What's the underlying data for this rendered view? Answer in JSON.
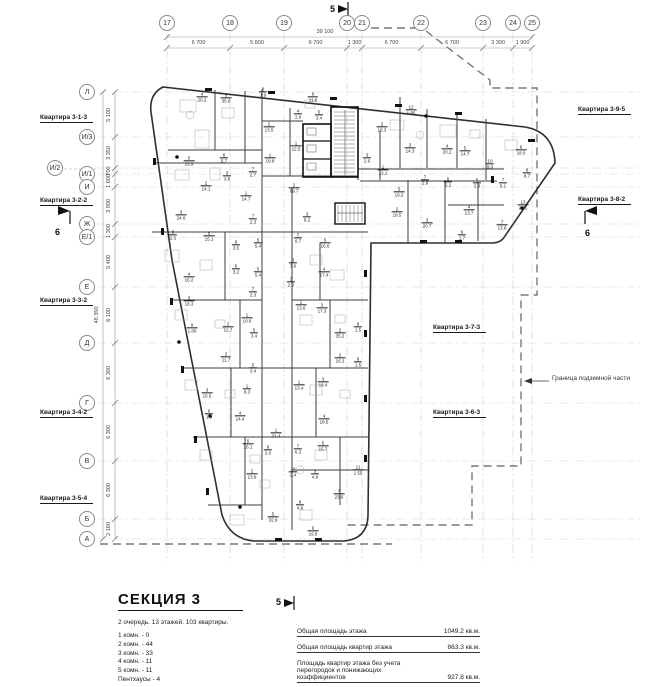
{
  "legend": {
    "title": "СЕКЦИЯ 3",
    "subtitle": "2 очередь. 13 этажей. 103 квартиры.",
    "unit_counts": [
      "1 комн. - 0",
      "2 комн. - 44",
      "3 комн. - 33",
      "4 комн. - 11",
      "5 комн. - 11",
      "Пентхаусы - 4"
    ],
    "totals": [
      {
        "label": "Общая площадь этажа",
        "value": "1049.2 кв.м."
      },
      {
        "label": "Общая площадь квартир этажа",
        "value": "863.3 кв.м."
      },
      {
        "label": "Площадь квартир этажа без учета перегородок и понижающих коэффициентов",
        "value": "927.8 кв.м."
      }
    ]
  },
  "boundary": {
    "label": "Граница подземной части"
  },
  "grid": {
    "columns": [
      {
        "label": "17",
        "x": 167
      },
      {
        "label": "18",
        "x": 230
      },
      {
        "label": "19",
        "x": 284
      },
      {
        "label": "20",
        "x": 347
      },
      {
        "label": "21",
        "x": 362
      },
      {
        "label": "22",
        "x": 421
      },
      {
        "label": "23",
        "x": 483
      },
      {
        "label": "24",
        "x": 513
      },
      {
        "label": "25",
        "x": 532
      }
    ],
    "rows": [
      {
        "label": "Л",
        "y": 92
      },
      {
        "label": "И/3",
        "y": 137
      },
      {
        "label": "И/1",
        "y": 174
      },
      {
        "label": "И",
        "y": 187
      },
      {
        "label": "Ж",
        "y": 224
      },
      {
        "label": "Е/1",
        "y": 237
      },
      {
        "label": "Е",
        "y": 287
      },
      {
        "label": "Д",
        "y": 343
      },
      {
        "label": "Г",
        "y": 403
      },
      {
        "label": "В",
        "y": 461
      },
      {
        "label": "Б",
        "y": 519
      },
      {
        "label": "А",
        "y": 539
      }
    ],
    "offset_row": {
      "label": "И/2",
      "x": 55,
      "y": 168
    },
    "dim_row_ys": [
      92,
      137,
      168,
      174,
      187,
      224,
      237,
      287,
      343,
      403,
      461,
      519,
      539
    ]
  },
  "dims": {
    "top": {
      "total": "39 100",
      "segments": [
        "6 700",
        "5 800",
        "6 700",
        "1 300",
        "6 700",
        "6 700",
        "3 300",
        "1 900"
      ]
    },
    "left": {
      "total": "48 350",
      "segments": [
        "5 100",
        "3 350",
        "700",
        "1 600",
        "3 900",
        "1 300",
        "5 400",
        "6 100",
        "6 300",
        "6 300",
        "6 300",
        "2 160"
      ]
    }
  },
  "sections": [
    {
      "label": "5",
      "x": 330,
      "y": 4
    },
    {
      "label": "5",
      "x": 276,
      "y": 597
    },
    {
      "label": "6",
      "x": 55,
      "y": 227
    },
    {
      "label": "6",
      "x": 585,
      "y": 228
    }
  ],
  "apartments": [
    {
      "label": "Квартира 3-1-3",
      "x": 40,
      "y": 114
    },
    {
      "label": "Квартира 3-2-2",
      "x": 40,
      "y": 197
    },
    {
      "label": "Квартира 3-3-2",
      "x": 40,
      "y": 297
    },
    {
      "label": "Квартира 3-4-2",
      "x": 40,
      "y": 409
    },
    {
      "label": "Квартира 3-5-4",
      "x": 40,
      "y": 495
    },
    {
      "label": "Квартира 3-9-5",
      "x": 578,
      "y": 106
    },
    {
      "label": "Квартира 3-8-2",
      "x": 578,
      "y": 196
    },
    {
      "label": "Квартира 3-7-3",
      "x": 433,
      "y": 324
    },
    {
      "label": "Квартира 3-6-3",
      "x": 433,
      "y": 409
    }
  ],
  "rooms": [
    [
      4,
      "20.2",
      202,
      97
    ],
    [
      3,
      "35.6",
      226,
      98
    ],
    [
      8,
      "1.9",
      263,
      92
    ],
    [
      6,
      "11.6",
      313,
      97
    ],
    [
      4,
      "2.9",
      298,
      114
    ],
    [
      5,
      "3.4",
      319,
      115
    ],
    [
      2,
      "13.5",
      269,
      127
    ],
    [
      1,
      "12.5",
      296,
      146
    ],
    [
      1,
      "19.8",
      270,
      158
    ],
    [
      5,
      "25.9",
      189,
      161
    ],
    [
      6,
      "5.7",
      224,
      158
    ],
    [
      7,
      "2.7",
      253,
      172
    ],
    [
      3,
      "3.8",
      227,
      176
    ],
    [
      2,
      "14.1",
      206,
      186
    ],
    [
      1,
      "14.7",
      246,
      196
    ],
    [
      2,
      "69.7",
      294,
      188
    ],
    [
      3,
      "8.2",
      307,
      217
    ],
    [
      3,
      "24.6",
      181,
      215
    ],
    [
      7,
      "2.3",
      253,
      219
    ],
    [
      3,
      "2.6",
      367,
      158
    ],
    [
      1,
      "12.1",
      383,
      170
    ],
    [
      12,
      "1.95",
      411,
      110
    ],
    [
      2,
      "18.3",
      382,
      127
    ],
    [
      3,
      "14.3",
      410,
      148
    ],
    [
      4,
      "20.2",
      447,
      149
    ],
    [
      5,
      "14.7",
      465,
      151
    ],
    [
      6,
      "18.0",
      521,
      150
    ],
    [
      10,
      "9.0",
      490,
      164
    ],
    [
      8,
      "8.7",
      527,
      173
    ],
    [
      7,
      "2.8",
      425,
      180
    ],
    [
      6,
      "5.2",
      448,
      182
    ],
    [
      5,
      "2.8",
      477,
      183
    ],
    [
      7,
      "5.1",
      503,
      183
    ],
    [
      13,
      "2.15",
      523,
      205
    ],
    [
      4,
      "13.7",
      469,
      210
    ],
    [
      5,
      "19.2",
      399,
      192
    ],
    [
      2,
      "19.5",
      397,
      212
    ],
    [
      3,
      "20.7",
      427,
      223
    ],
    [
      6,
      "1.7",
      462,
      235
    ],
    [
      7,
      "13.8",
      502,
      225
    ],
    [
      9,
      "2.5",
      173,
      235
    ],
    [
      5,
      "15.1",
      209,
      236
    ],
    [
      8,
      "3.5",
      236,
      245
    ],
    [
      5,
      "5.4",
      258,
      243
    ],
    [
      6,
      "3.2",
      236,
      269
    ],
    [
      5,
      "5.4",
      258,
      272
    ],
    [
      4,
      "16.2",
      189,
      277
    ],
    [
      3,
      "18.3",
      189,
      301
    ],
    [
      7,
      "2.3",
      253,
      292
    ],
    [
      1,
      "10.8",
      247,
      318
    ],
    [
      9,
      "1.80",
      192,
      328
    ],
    [
      2,
      "12.7",
      228,
      327
    ],
    [
      2,
      "11.7",
      226,
      357
    ],
    [
      5,
      "3.4",
      254,
      333
    ],
    [
      5,
      "3.4",
      253,
      368
    ],
    [
      1,
      "8.3",
      247,
      389
    ],
    [
      3,
      "15.5",
      207,
      393
    ],
    [
      7,
      "6.7",
      298,
      238
    ],
    [
      5,
      "16.6",
      325,
      243
    ],
    [
      3,
      "3.6",
      293,
      263
    ],
    [
      3,
      "2.0",
      291,
      282
    ],
    [
      4,
      "17.4",
      324,
      272
    ],
    [
      1,
      "13.6",
      301,
      305
    ],
    [
      3,
      "17.3",
      322,
      308
    ],
    [
      2,
      "35.2",
      340,
      333
    ],
    [
      9,
      "1.5",
      358,
      327
    ],
    [
      2,
      "16.2",
      340,
      358
    ],
    [
      9,
      "1.5",
      358,
      362
    ],
    [
      1,
      "13.4",
      299,
      385
    ],
    [
      3,
      "18.4",
      323,
      382
    ],
    [
      6,
      "1.9",
      209,
      414
    ],
    [
      4,
      "14.4",
      240,
      416
    ],
    [
      1,
      "21.4",
      276,
      433
    ],
    [
      5,
      "16.1",
      248,
      444
    ],
    [
      9,
      "2.0",
      268,
      450
    ],
    [
      7,
      "6.3",
      298,
      449
    ],
    [
      5,
      "15.7",
      323,
      446
    ],
    [
      4,
      "18.5",
      324,
      419
    ],
    [
      10,
      "2.4",
      293,
      472
    ],
    [
      3,
      "4.9",
      315,
      474
    ],
    [
      11,
      "1.55",
      358,
      470
    ],
    [
      2,
      "13.9",
      252,
      474
    ],
    [
      7,
      "23.6",
      339,
      494
    ],
    [
      8,
      "4.6",
      300,
      505
    ],
    [
      5,
      "32.9",
      273,
      517
    ],
    [
      6,
      "19.9",
      313,
      531
    ]
  ]
}
